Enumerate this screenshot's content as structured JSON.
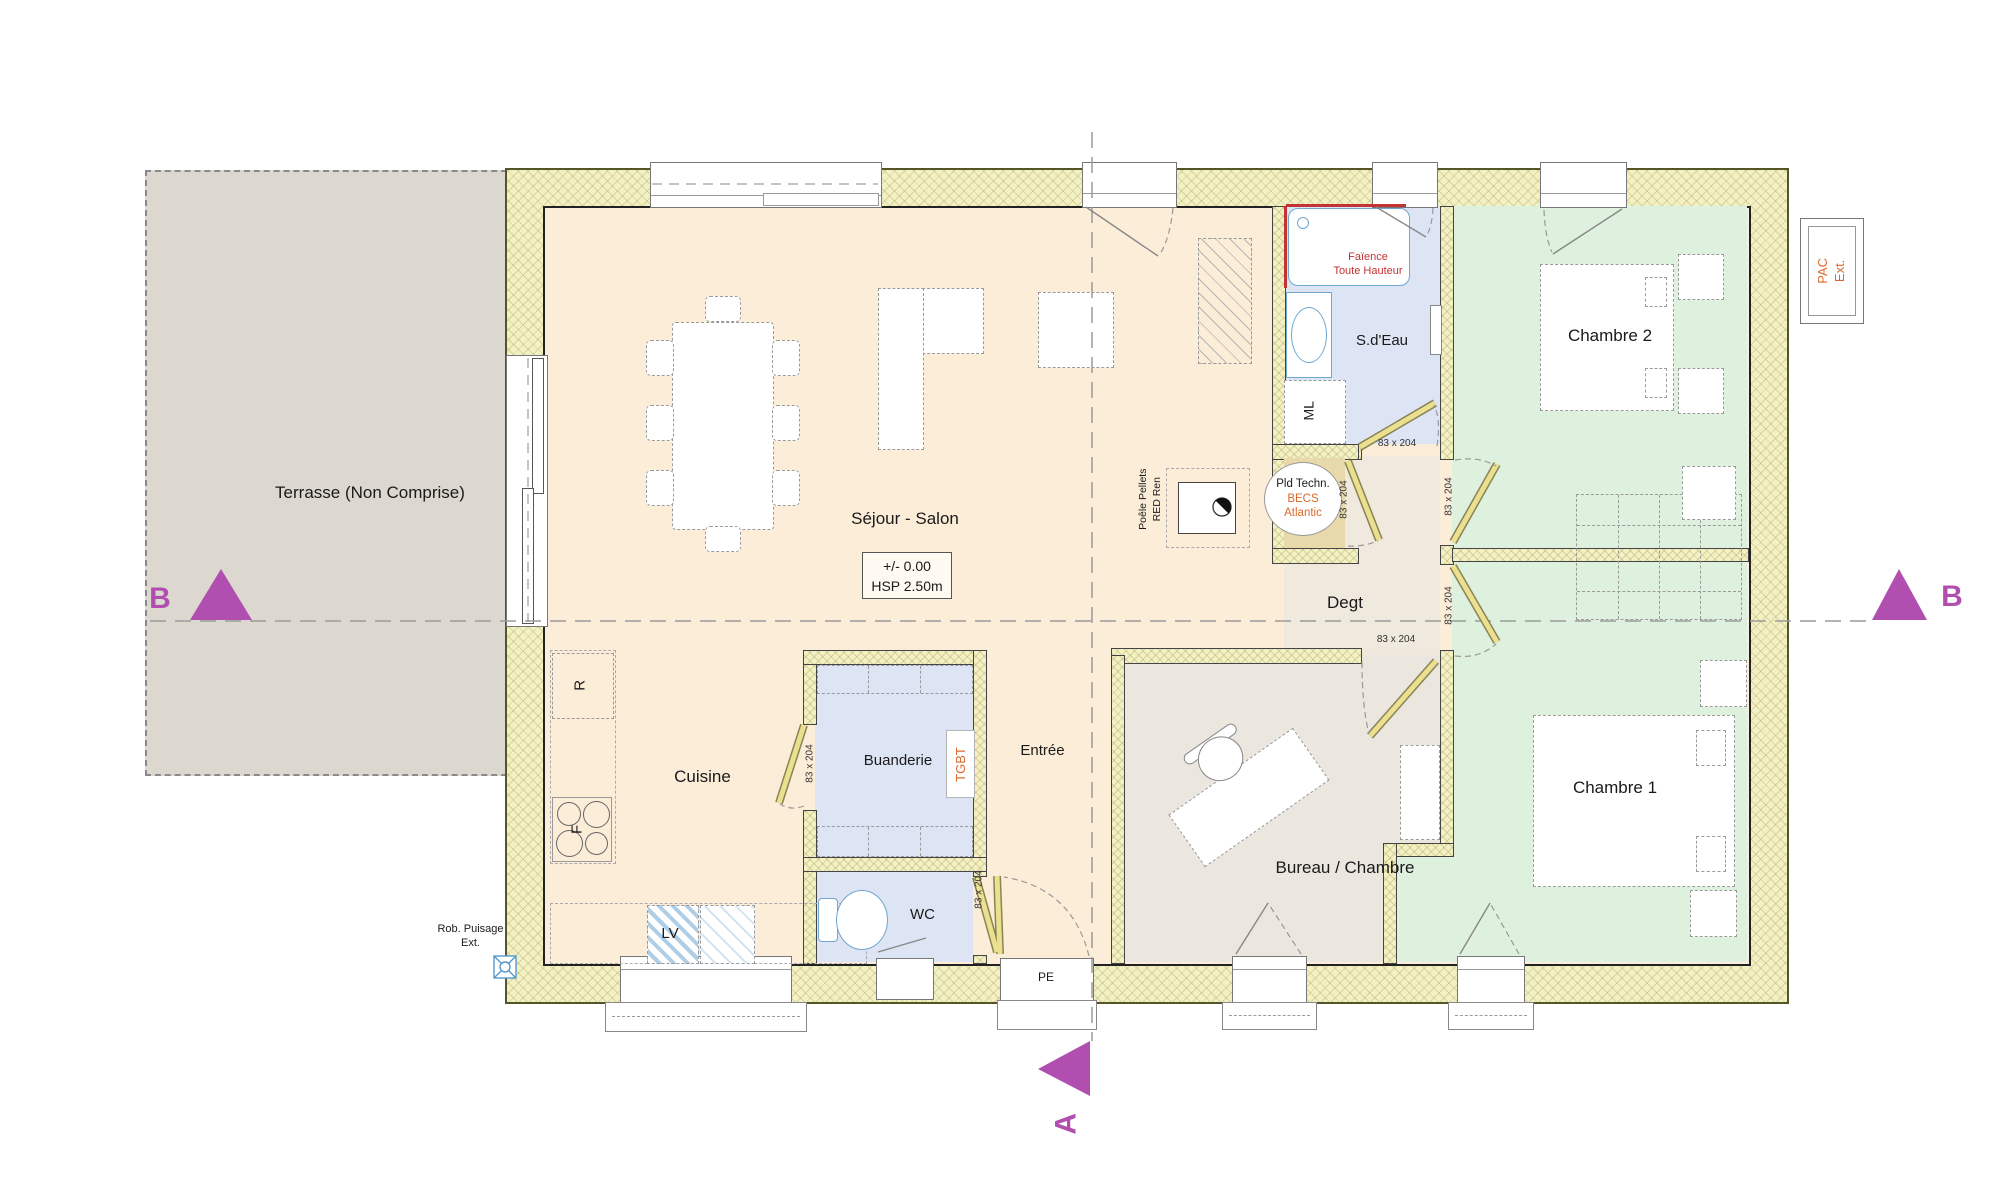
{
  "plan": {
    "terrace": "Terrasse (Non Comprise)",
    "rooms": {
      "sejour": "Séjour - Salon",
      "cuisine": "Cuisine",
      "buanderie": "Buanderie",
      "wc": "WC",
      "entree": "Entrée",
      "bureau": "Bureau / Chambre",
      "degt": "Degt",
      "sdeau": "S.d'Eau",
      "chambre1": "Chambre 1",
      "chambre2": "Chambre 2"
    },
    "tech_room": {
      "title": "Pld Techn.",
      "line1": "BECS",
      "line2": "Atlantic"
    },
    "elevation": {
      "level": "+/- 0.00",
      "ceiling": "HSP 2.50m"
    },
    "equipment": {
      "fridge": "R",
      "oven": "F",
      "dishwasher": "LV",
      "washer": "ML",
      "panel": "TGBT",
      "entry_door": "PE"
    },
    "annotations": {
      "tiling1": "Faïence",
      "tiling2": "Toute Hauteur",
      "stove1": "Poêle Pellets",
      "stove2": "RED Ren",
      "tap1": "Rob. Puisage",
      "tap2": "Ext.",
      "pac1": "PAC",
      "pac2": "Ext."
    },
    "door_size": "83 x 204",
    "sections": {
      "a": "A",
      "b": "B"
    },
    "colors": {
      "section_marker": "#b14fb1",
      "orange_label": "#d96a2e",
      "red_label": "#c23333",
      "fixture_blue": "#6fa8d2",
      "wall_fill": "#f3f0c4",
      "floor_living": "#fcedd8",
      "floor_bedroom": "#def0de",
      "floor_wet": "#dde4f3",
      "floor_hall": "#f0e9dd",
      "floor_office": "#ebe6de",
      "floor_tech": "#e8d9ab",
      "terrace": "#dcd8cf",
      "door_leaf": "#eae08f"
    }
  }
}
